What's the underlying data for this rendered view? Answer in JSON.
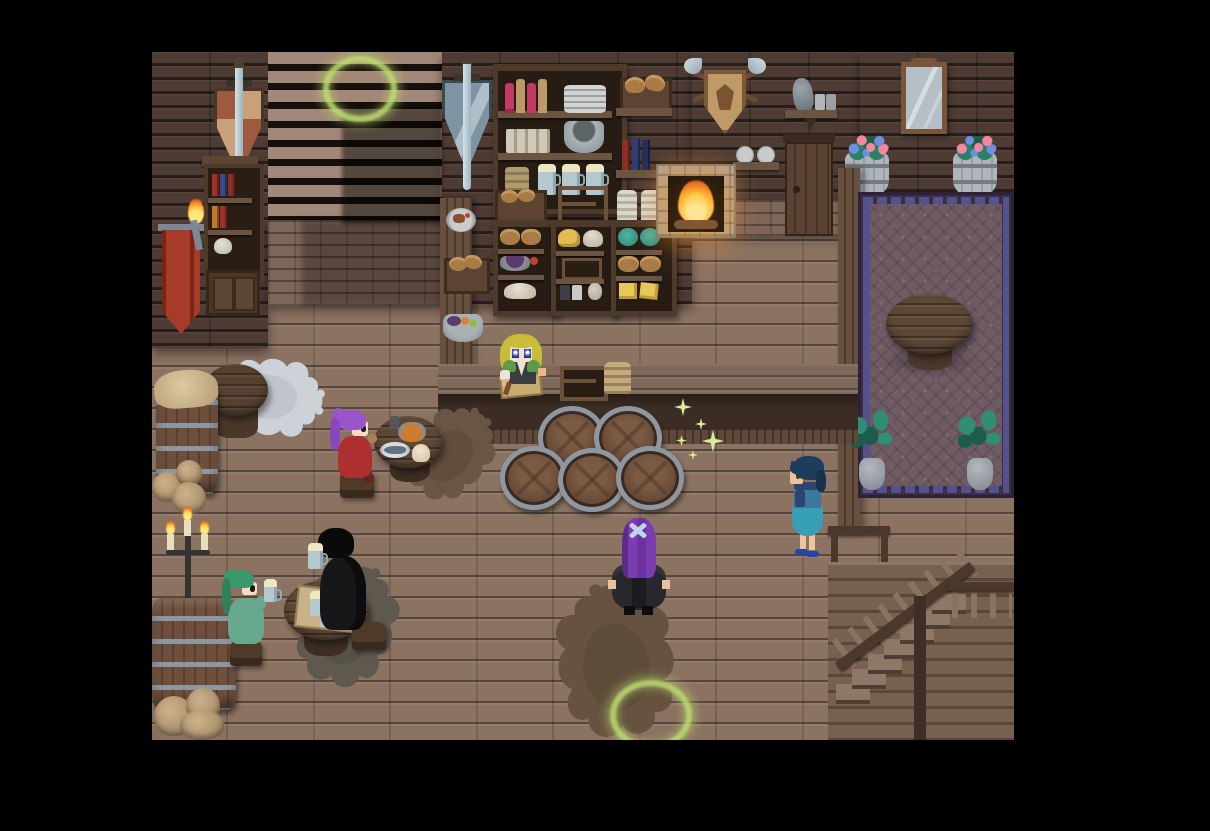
{
  "app": {
    "name": "pixel-rpg",
    "scene": "Tavern interior",
    "ui_text_visible": false
  },
  "viewport": {
    "left": 152,
    "top": 52,
    "width": 862,
    "height": 688,
    "letterbox_color": "#000000"
  },
  "palette": {
    "floor": "#8b7261",
    "wall": "#4e3c34",
    "brick": "#7d6557",
    "counter": "#7d685a",
    "rug": "#6f5b64",
    "rug_border": "#3b2d44",
    "barrel": "#6e4f3c",
    "steel_band": "#8e96a0",
    "fire": "#ffab2e",
    "glow": "#bede70",
    "sparkle": "#d9ea9a",
    "beer_foam": "#efe6c2"
  },
  "characters": [
    {
      "id": "barmaid",
      "name": "Barmaid",
      "hair": "blonde",
      "outfit": "dark dress with green shawl and white sleeve",
      "activity": "working at bar counter with knife and cutting board"
    },
    {
      "id": "purple-diner",
      "name": "Purple-haired patron",
      "hair": "purple ponytail",
      "outfit": "red dress",
      "activity": "eating at a small round table"
    },
    {
      "id": "green-drinker",
      "name": "Green-haired patron",
      "hair": "green ponytail",
      "outfit": "teal robe",
      "activity": "raising a foaming beer mug"
    },
    {
      "id": "black-robed-patron",
      "name": "Black-robed patron",
      "hair": "black bob",
      "outfit": "black hooded robe",
      "activity": "drinking beer at table"
    },
    {
      "id": "player",
      "name": "Player character",
      "hair": "long purple with pale cross hairpin",
      "outfit": "dark grey cloak",
      "activity": "standing on large bear rug"
    },
    {
      "id": "blue-villager",
      "name": "Blue-haired villager",
      "hair": "dark blue bob",
      "outfit": "teal dress with navy shawl",
      "activity": "standing near the stair landing"
    }
  ],
  "objects": {
    "wall_decor": [
      "tan-red pennant with sword",
      "steel-blue pennant with sword",
      "red banner",
      "bookshelf with books and cabinet",
      "left wall torch",
      "crossed-axes hunting trophy with crest",
      "jug shelf",
      "two-plate shelf",
      "wooden door",
      "stone fireplace with burning fire",
      "framed mirror",
      "right wall torch"
    ],
    "bar": [
      "long bar counter",
      "cutting board with knife",
      "open wooden rack",
      "woven basket",
      "five side-stacked barrels",
      "supply pillar with plate, bread crate and fruit bowl"
    ],
    "shelves": [
      "large shelf with bottles, plate stack, cups, bowl, basket and blue mugs",
      "bread wall shelf",
      "book wall shelf",
      "two flour sacks",
      "food shelf: bread, grapes, flour",
      "food shelf: cheese wheel, crate, jars",
      "food shelf: cabbages, bread, cheese blocks"
    ],
    "furniture": [
      "cloth-covered barrel",
      "supply sacks",
      "round table on polar-bear rug",
      "dining table with soup pot, fish plate and mash",
      "beer table with tray of foaming mugs",
      "stacked barrels bottom-left",
      "iron candelabra with three lit candles",
      "round table in rug alcove",
      "wooden stools"
    ],
    "rugs": [
      "polar bear rug",
      "small brown bear rug",
      "grey bear rug",
      "large brown bear rug",
      "patterned purple alcove rug"
    ],
    "plants": [
      "flower barrel left",
      "flower barrel right",
      "potted plant left",
      "potted plant right"
    ],
    "architecture": [
      "upper-floor staircase (top-left, shadowed)",
      "descending wooden staircase (bottom-right)",
      "stair landing railing",
      "vertical wall divider"
    ]
  },
  "effects": {
    "glow_rings": [
      {
        "cx": 203,
        "cy": 31
      },
      {
        "cx": 493,
        "cy": 657
      }
    ],
    "glow_color": "#bede70",
    "sparkle_count": 5,
    "fire_color": "#ffab2e",
    "lit_candles": 3,
    "lit_torches": 2
  }
}
